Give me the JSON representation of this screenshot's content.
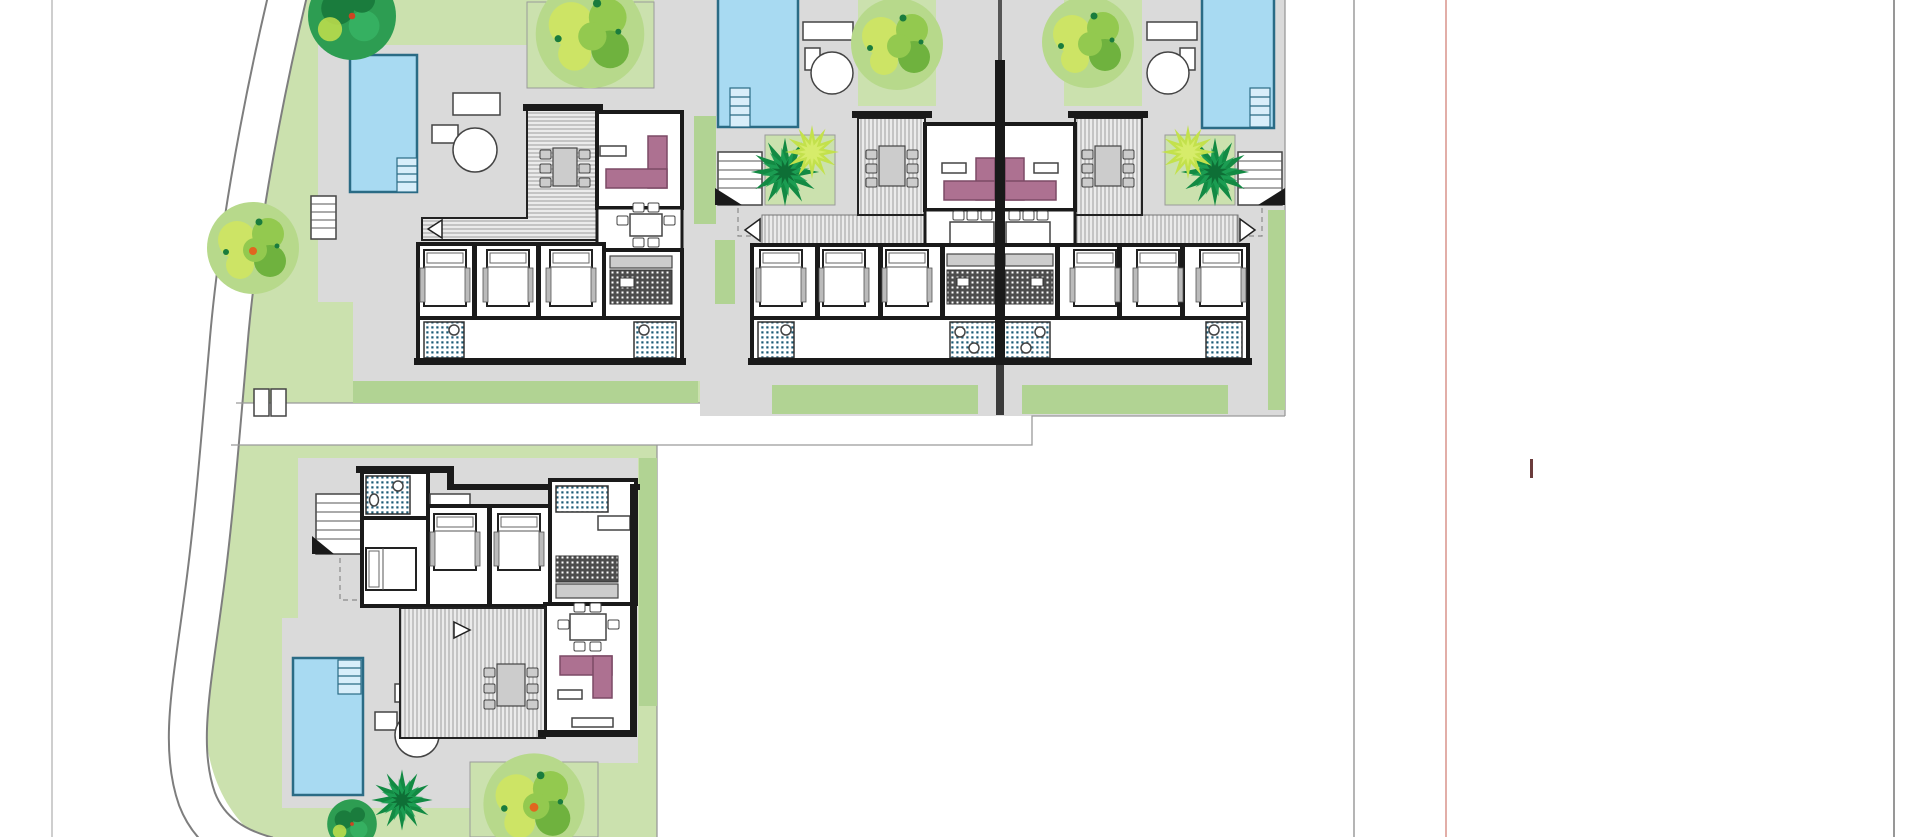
{
  "canvas": {
    "width": 1920,
    "height": 837,
    "background": "#ffffff"
  },
  "guides": {
    "page_edge_left": {
      "x": 52,
      "y1": 0,
      "y2": 837
    },
    "column_line": {
      "x": 1354,
      "y1": 0,
      "y2": 837
    },
    "red_margin_line": {
      "x": 1446,
      "y1": 0,
      "y2": 837
    },
    "page_edge_right": {
      "x": 1894,
      "y1": 0,
      "y2": 837
    },
    "red_marker": {
      "x": 1530,
      "y": 459,
      "w": 3,
      "h": 19
    }
  },
  "site": {
    "villa_count": 4,
    "pool_count": 4,
    "semidetached_pair": true
  },
  "colors": {
    "pageBg": "#ffffff",
    "frameLeft": "#b4b4b4",
    "frameMid": "#8d8d8d",
    "frameRedLine": "#d2837a",
    "frameRight": "#979797",
    "redMarker": "#6b3c3c",
    "lawn": "#cbe1ae",
    "hedge": "#b1d393",
    "paving": "#dadada",
    "bound": "#9a9a9a",
    "roadEdge": "#7e7e7e",
    "pool": "#a8daf2",
    "poolDark": "#2a6b85",
    "poolStep": "#d8eefa",
    "wall": "#1a1a1a",
    "deckBg": "#ebebeb",
    "deckLine": "#9c9c9c",
    "sofa": "#ad7191",
    "sofaDark": "#7c4a66",
    "furnGray": "#cccccc",
    "furnStroke": "#444444",
    "bathDot": "#1d5b76",
    "kitchenBg": "#4d4d4d",
    "treeBase": "#b7d98b",
    "treeBlob1": "#cde465",
    "treeBlob2": "#93c94f",
    "treeBlob3": "#6fb23e",
    "treeDark": "#2d9d52",
    "treeDarker": "#1a7c3d",
    "palm": "#128a43",
    "lime": "#c3e14c",
    "orange": "#e0661f"
  }
}
